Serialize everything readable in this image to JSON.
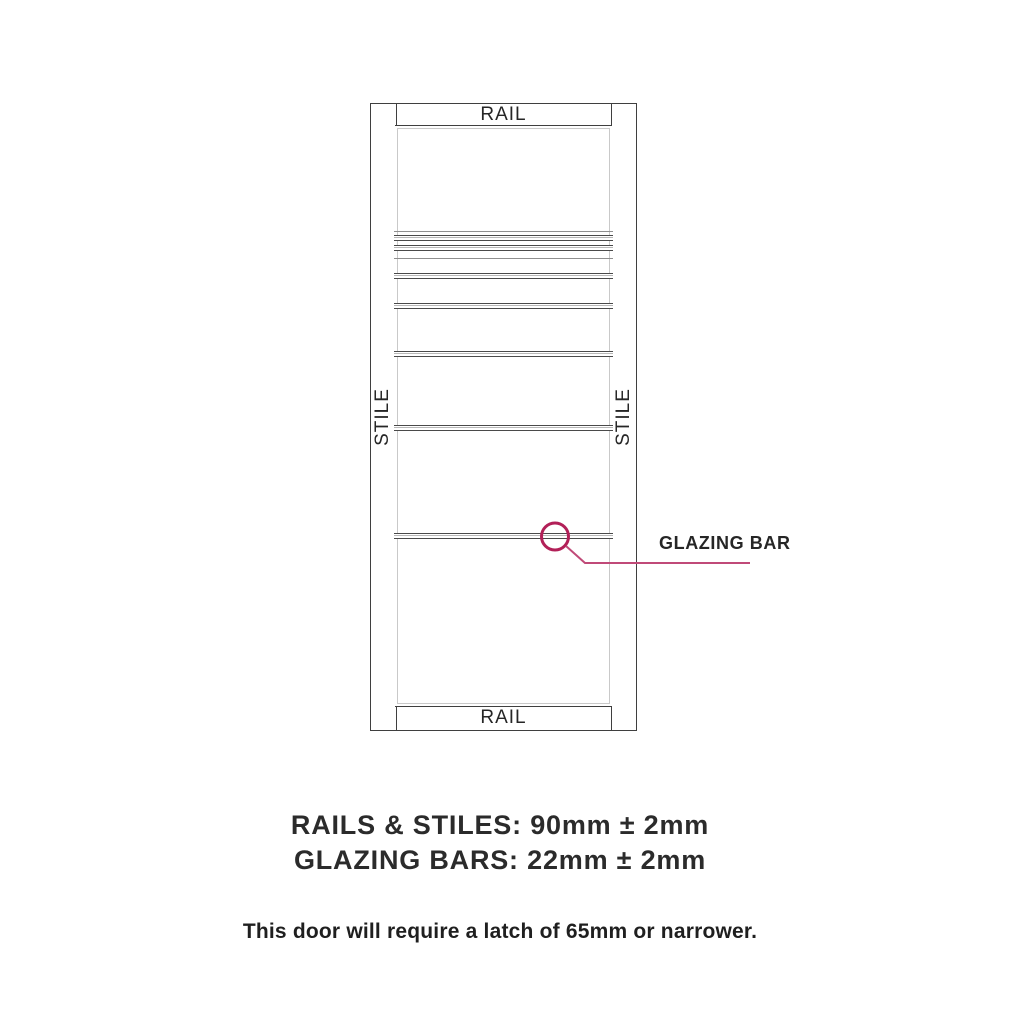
{
  "canvas": {
    "background": "#ffffff"
  },
  "door": {
    "rail_top_label": "RAIL",
    "rail_bottom_label": "RAIL",
    "stile_left_label": "STILE",
    "stile_right_label": "STILE",
    "line_color": "#3f3f3f",
    "glass_elements": [
      {
        "type": "bead",
        "top": 105
      },
      {
        "type": "bar",
        "top": 109
      },
      {
        "type": "bar",
        "top": 119
      },
      {
        "type": "bead",
        "top": 132
      },
      {
        "type": "bar",
        "top": 147
      },
      {
        "type": "bar",
        "top": 177
      },
      {
        "type": "bar",
        "top": 225
      },
      {
        "type": "bar",
        "top": 299
      },
      {
        "type": "bar",
        "top": 407
      }
    ]
  },
  "callout": {
    "label": "GLAZING BAR",
    "circle_color": "#b22058",
    "line_color": "#c04a78"
  },
  "specs": {
    "rails_stiles": "RAILS & STILES: 90mm ± 2mm",
    "glazing_bars": "GLAZING BARS: 22mm ± 2mm",
    "note": "This door will require a latch of 65mm or narrower."
  }
}
